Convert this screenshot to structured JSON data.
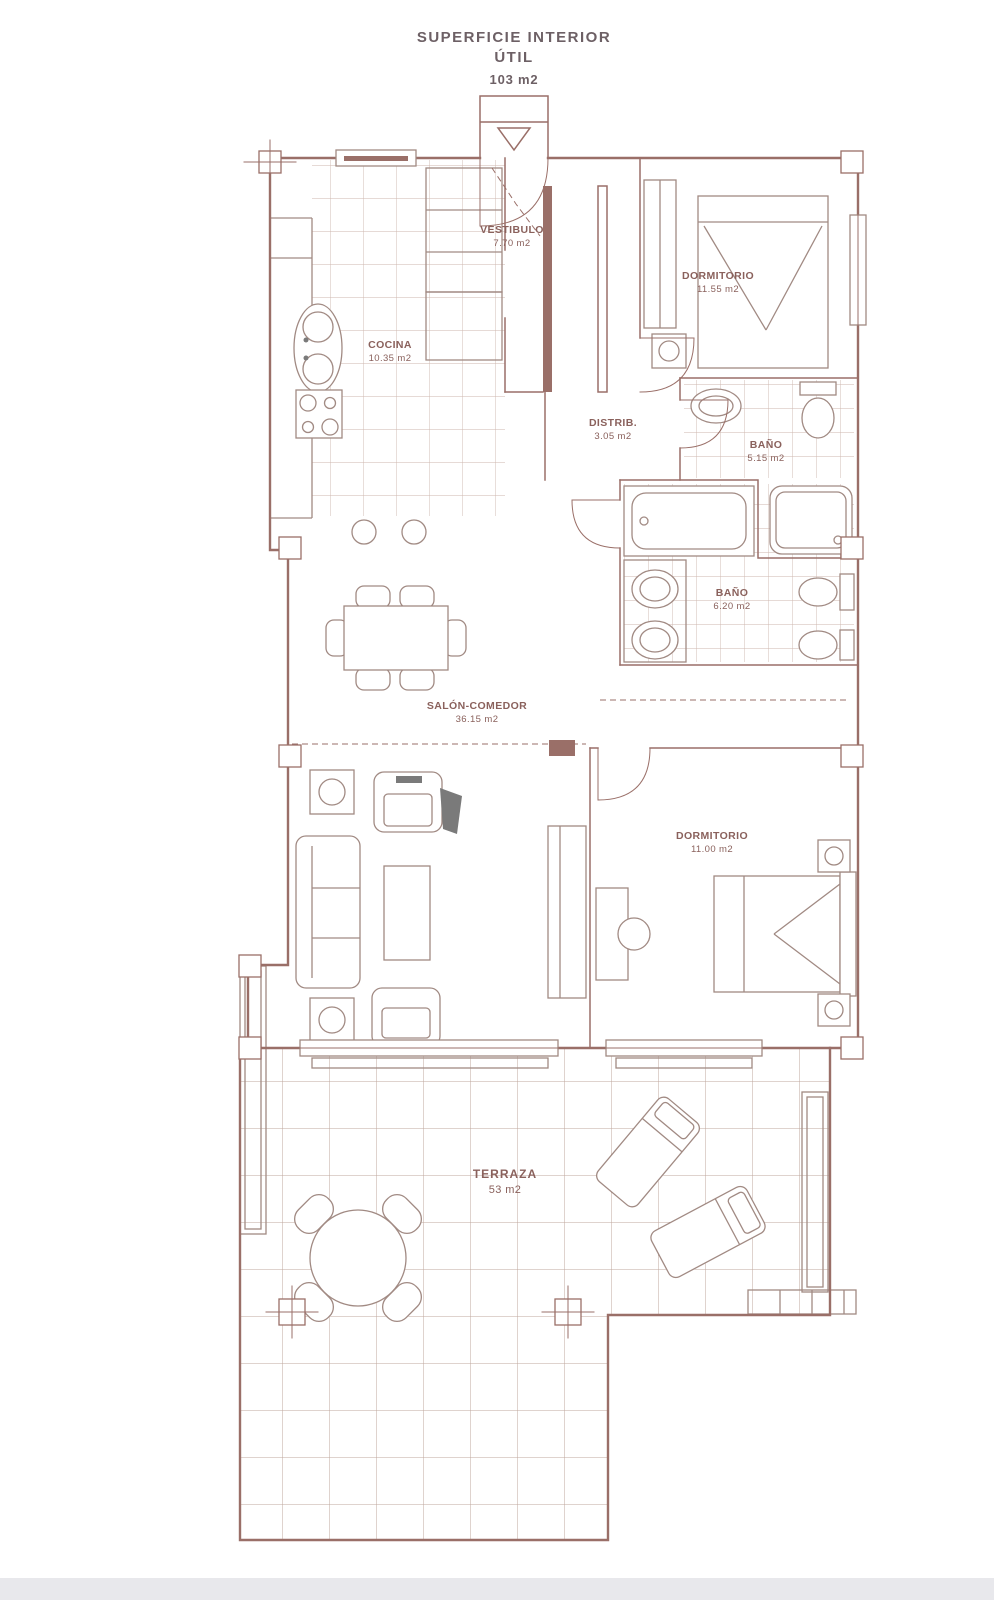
{
  "title": {
    "text": "SUPERFICIE INTERIOR ÚTIL",
    "area": "103 m2"
  },
  "rooms": {
    "vestibulo": {
      "name": "VESTIBULO",
      "area": "7.70 m2"
    },
    "dormitorio1": {
      "name": "DORMITORIO",
      "area": "11.55 m2"
    },
    "cocina": {
      "name": "COCINA",
      "area": "10.35 m2"
    },
    "distribuidor": {
      "name": "DISTRIB.",
      "area": "3.05 m2"
    },
    "bano1": {
      "name": "BAÑO",
      "area": "5.15 m2"
    },
    "bano2": {
      "name": "BAÑO",
      "area": "6.20 m2"
    },
    "salon": {
      "name": "SALÓN-COMEDOR",
      "area": "36.15 m2"
    },
    "dormitorio2": {
      "name": "DORMITORIO",
      "area": "11.00 m2"
    },
    "terraza": {
      "name": "TERRAZA",
      "area": "53 m2"
    }
  },
  "colors": {
    "wall": "#9a6f68",
    "furniture": "#a18a83",
    "tile": "#cdb6ae",
    "tile_terrace": "#bfa79e",
    "label": "#8a615c",
    "title": "#6d6065",
    "footer": "#e8e8ec"
  }
}
